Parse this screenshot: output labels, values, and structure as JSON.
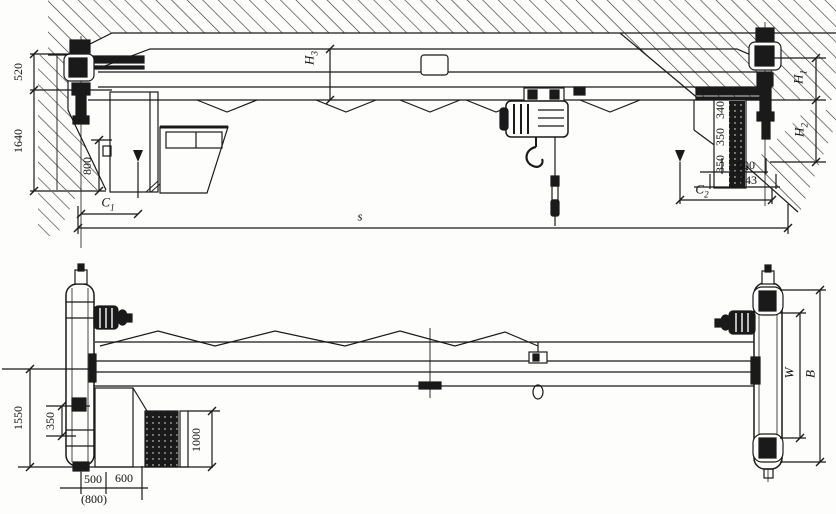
{
  "top": {
    "d520": "520",
    "d1640": "1640",
    "d800": "800",
    "c1": {
      "base": "C",
      "sub": "1"
    },
    "span": "s",
    "h3": {
      "base": "H",
      "sub": "3"
    },
    "h1": {
      "base": "H",
      "sub": "1"
    },
    "h2": {
      "base": "H",
      "sub": "2"
    },
    "rail_stack": [
      "340",
      "350",
      "350"
    ],
    "d600": "600",
    "d743": "743",
    "c2": {
      "base": "C",
      "sub": "2"
    }
  },
  "bottom": {
    "d1550": "1550",
    "d350": "350",
    "d500": "500",
    "d800_alt": "(800)",
    "d600": "600",
    "d1000": "1000",
    "w": "W",
    "b": "B"
  },
  "colors": {
    "ink": "#1a1a1a",
    "paper": "#fdfdfb"
  }
}
